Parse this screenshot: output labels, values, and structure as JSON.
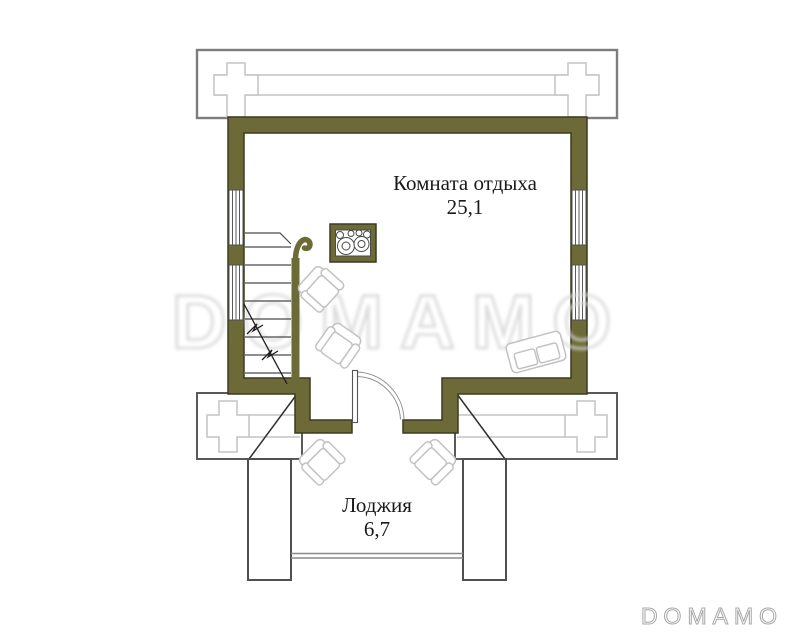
{
  "plan": {
    "rooms": [
      {
        "id": "rest-room",
        "name": "Комната отдыха",
        "area": "25,1"
      },
      {
        "id": "loggia",
        "name": "Лоджия",
        "area": "6,7"
      }
    ],
    "furniture": [
      "stove",
      "armchair",
      "armchair",
      "sofa",
      "armchair",
      "armchair"
    ],
    "features": [
      "log-walls",
      "staircase-with-railing",
      "swing-door",
      "double-windows",
      "loggia-railing"
    ]
  },
  "watermark": {
    "center": "DOMAMO",
    "footer": "DOMAMO"
  },
  "colors": {
    "wall_fill": "#6C6B37",
    "wall_outline": "#3B3A22",
    "outline_light": "#C4C4C4",
    "furniture_line": "#C2C2C2",
    "watermark_line": "#D8D8D8",
    "footer_line": "#A8A8A8",
    "text": "#1A1A1A"
  }
}
